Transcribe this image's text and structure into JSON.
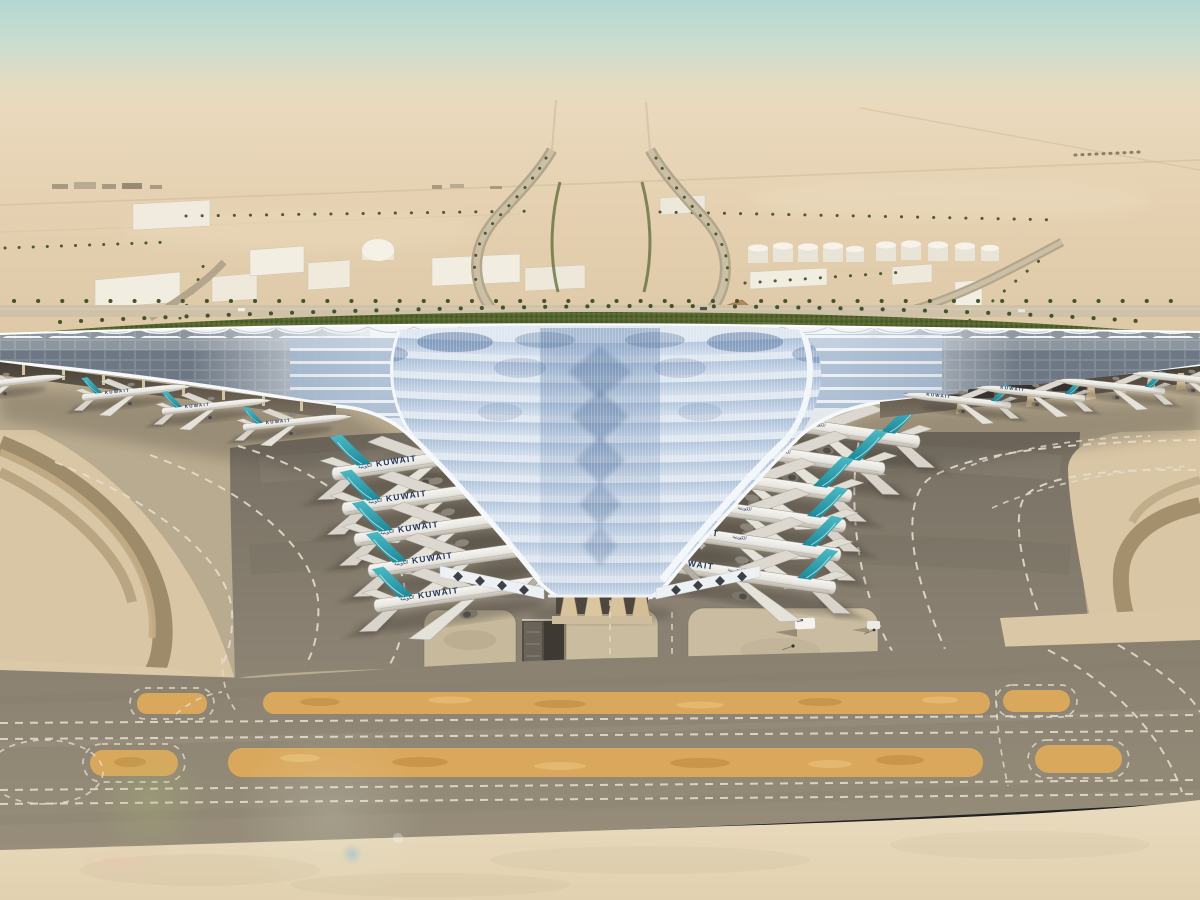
{
  "scene": {
    "subject": "aerial-rendering-airport-terminal",
    "airline": {
      "title": "KUWAIT",
      "title_arabic": "الكويتية"
    },
    "fleet": {
      "left_gate_planes": 5,
      "right_gate_planes": 6,
      "left_pier_planes": 4,
      "right_pier_planes": 4
    },
    "palette": {
      "sky_top": "#b4d8d1",
      "horizon_haze": "#ead9bd",
      "desert_sand": "#e0cdac",
      "roof_silver": "#eef1f4",
      "roof_panel_blue": "#9fb6d2",
      "roof_panel_dark": "#54749f",
      "pv_panel_gray": "#67727e",
      "tail_teal": "#2d9fae",
      "fuselage_white": "#f0efeb",
      "title_navy": "#23365e",
      "greenery": "#55652f",
      "apron_asphalt": "#7f776a",
      "apron_concrete": "#c6b99c",
      "taxiway_gray": "#8b8170",
      "blast_pad_orange": "#d9a85c",
      "marking_white": "#e3dccb",
      "shadow_brown": "#93805f"
    }
  }
}
